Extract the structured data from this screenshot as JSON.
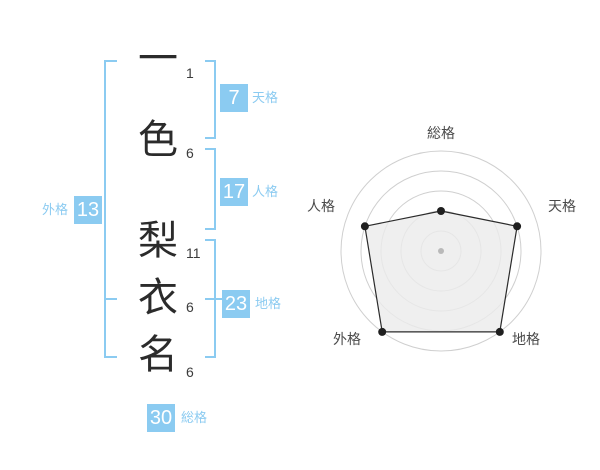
{
  "accent_color": "#8BCBF1",
  "name_panel": {
    "characters": [
      {
        "char": "一",
        "strokes": "1"
      },
      {
        "char": "色",
        "strokes": "6"
      },
      {
        "char": "梨",
        "strokes": "11"
      },
      {
        "char": "衣",
        "strokes": "6"
      },
      {
        "char": "名",
        "strokes": "6"
      }
    ],
    "kaku": {
      "ten": {
        "label": "天格",
        "value": "7"
      },
      "jin": {
        "label": "人格",
        "value": "17"
      },
      "chi": {
        "label": "地格",
        "value": "23"
      },
      "gai": {
        "label": "外格",
        "value": "13"
      },
      "sou": {
        "label": "総格",
        "value": "30"
      }
    }
  },
  "chart_data": {
    "type": "radar",
    "title": "",
    "axes": [
      {
        "label": "総格",
        "angle": 90,
        "value": 2
      },
      {
        "label": "天格",
        "angle": 18,
        "value": 4
      },
      {
        "label": "地格",
        "angle": -54,
        "value": 5
      },
      {
        "label": "外格",
        "angle": -126,
        "value": 5
      },
      {
        "label": "人格",
        "angle": 162,
        "value": 4
      }
    ],
    "max": 5,
    "rings": 5,
    "grid": "concentric-circles",
    "legend": "none",
    "colors": {
      "ring": "#cfcfcf",
      "polygon_fill": "#ebebeb",
      "polygon_stroke": "#2b2b2b",
      "point": "#1f1f1f",
      "center_dot": "#b9b9b9",
      "label": "#4a4a4a"
    }
  }
}
